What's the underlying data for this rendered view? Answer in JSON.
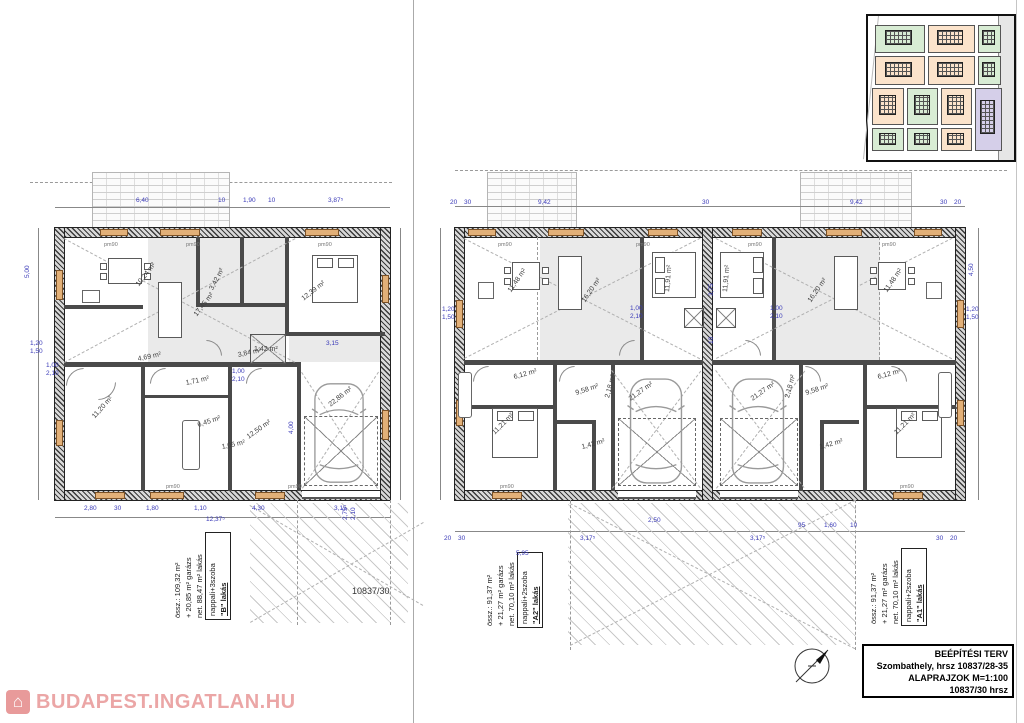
{
  "title_block": {
    "line1": "BEÉPÍTÉSI TERV",
    "line2": "Szombathely, hrsz 10837/28-35",
    "line3": "ALAPRAJZOK M=1:100",
    "line4": "10837/30 hrsz"
  },
  "watermark": {
    "text": "BUDAPEST.INGATLAN.HU",
    "color": "#eba6a6"
  },
  "sheet": {
    "parcel_label": "10837/30"
  },
  "units": {
    "b": {
      "title": "\"B\" lakás",
      "subtitle": "nappali+3szoba",
      "net": "net. 88,47 m² lakás",
      "garage": "+ 20,85 m² garázs",
      "total": "össz.: 109,32 m²"
    },
    "a2": {
      "title": "\"A2\" lakás",
      "subtitle": "nappali+2szoba",
      "net": "net. 70,10 m² lakás",
      "garage": "+ 21,27 m² garázs",
      "total": "össz.: 91,37 m²"
    },
    "a1": {
      "title": "\"A1\" lakás",
      "subtitle": "nappali+2szoba",
      "net": "net. 70,10 m² lakás",
      "garage": "+ 21,27 m² garázs",
      "total": "össz.: 91,37 m²"
    }
  },
  "left_plan": {
    "rooms": [
      {
        "t": "10,24 m²",
        "x": 138,
        "y": 282,
        "r": -52
      },
      {
        "t": "17,45 m²",
        "x": 196,
        "y": 312,
        "r": -52
      },
      {
        "t": "12,39 m²",
        "x": 303,
        "y": 296,
        "r": -38
      },
      {
        "t": "3,42 m²",
        "x": 212,
        "y": 286,
        "r": -62
      },
      {
        "t": "1,42 m²",
        "x": 254,
        "y": 346,
        "r": 0
      },
      {
        "t": "4,69 m²",
        "x": 138,
        "y": 356,
        "r": -12
      },
      {
        "t": "3,84 m²",
        "x": 238,
        "y": 352,
        "r": -12
      },
      {
        "t": "11,20 m²",
        "x": 94,
        "y": 414,
        "r": -48
      },
      {
        "t": "1,71 m²",
        "x": 186,
        "y": 380,
        "r": -12
      },
      {
        "t": "6,45 m²",
        "x": 198,
        "y": 422,
        "r": -18
      },
      {
        "t": "1,05 m²",
        "x": 222,
        "y": 444,
        "r": -12
      },
      {
        "t": "12,50 m²",
        "x": 248,
        "y": 434,
        "r": -35
      },
      {
        "t": "22,86 m²",
        "x": 330,
        "y": 402,
        "r": -38
      }
    ],
    "dims": [
      {
        "t": "6,40",
        "x": 136,
        "y": 197
      },
      {
        "t": "10",
        "x": 218,
        "y": 197
      },
      {
        "t": "1,90",
        "x": 243,
        "y": 197
      },
      {
        "t": "10",
        "x": 268,
        "y": 197
      },
      {
        "t": "3,87⁵",
        "x": 328,
        "y": 197
      },
      {
        "t": "2,80",
        "x": 84,
        "y": 505
      },
      {
        "t": "30",
        "x": 114,
        "y": 505
      },
      {
        "t": "1,80",
        "x": 146,
        "y": 505
      },
      {
        "t": "1,10",
        "x": 194,
        "y": 505
      },
      {
        "t": "4,30",
        "x": 252,
        "y": 505
      },
      {
        "t": "3,15",
        "x": 334,
        "y": 505
      },
      {
        "t": "12,37⁵",
        "x": 206,
        "y": 516
      },
      {
        "t": "5,00",
        "x": 24,
        "y": 278,
        "r": -90
      },
      {
        "t": "4,00",
        "x": 288,
        "y": 434,
        "r": -90
      },
      {
        "t": "1,00",
        "x": 46,
        "y": 362
      },
      {
        "t": "2,10",
        "x": 46,
        "y": 370
      },
      {
        "t": "1,00",
        "x": 232,
        "y": 368
      },
      {
        "t": "2,10",
        "x": 232,
        "y": 376
      },
      {
        "t": "3,15",
        "x": 326,
        "y": 340
      },
      {
        "t": "2,75",
        "x": 342,
        "y": 520,
        "r": -90
      },
      {
        "t": "2,10",
        "x": 350,
        "y": 520,
        "r": -90
      },
      {
        "t": "1,20",
        "x": 30,
        "y": 340
      },
      {
        "t": "1,50",
        "x": 30,
        "y": 348
      }
    ],
    "marks": [
      {
        "t": "pm90",
        "x": 104,
        "y": 242
      },
      {
        "t": "pm90",
        "x": 186,
        "y": 242
      },
      {
        "t": "pm90",
        "x": 318,
        "y": 242
      },
      {
        "t": "pm90",
        "x": 166,
        "y": 484
      },
      {
        "t": "pm90",
        "x": 288,
        "y": 484
      }
    ]
  },
  "right_plan": {
    "rooms": [
      {
        "t": "11,48 m²",
        "x": 510,
        "y": 288,
        "r": -55
      },
      {
        "t": "16,20 m²",
        "x": 584,
        "y": 298,
        "r": -55
      },
      {
        "t": "11,91 m²",
        "x": 668,
        "y": 288,
        "r": -85
      },
      {
        "t": "11,91 m²",
        "x": 726,
        "y": 288,
        "r": -85
      },
      {
        "t": "16,20 m²",
        "x": 810,
        "y": 298,
        "r": -55
      },
      {
        "t": "11,48 m²",
        "x": 886,
        "y": 288,
        "r": -55
      },
      {
        "t": "6,12 m²",
        "x": 514,
        "y": 374,
        "r": -15
      },
      {
        "t": "9,58 m²",
        "x": 576,
        "y": 390,
        "r": -18
      },
      {
        "t": "2,18 m²",
        "x": 608,
        "y": 394,
        "r": -75
      },
      {
        "t": "21,27 m²",
        "x": 630,
        "y": 396,
        "r": -35
      },
      {
        "t": "21,27 m²",
        "x": 752,
        "y": 396,
        "r": -35
      },
      {
        "t": "2,18 m²",
        "x": 788,
        "y": 394,
        "r": -75
      },
      {
        "t": "9,58 m²",
        "x": 806,
        "y": 390,
        "r": -18
      },
      {
        "t": "6,12 m²",
        "x": 878,
        "y": 374,
        "r": -15
      },
      {
        "t": "11,21 m²",
        "x": 494,
        "y": 430,
        "r": -45
      },
      {
        "t": "11,21 m²",
        "x": 896,
        "y": 430,
        "r": -45
      },
      {
        "t": "1,42 m²",
        "x": 582,
        "y": 444,
        "r": -15
      },
      {
        "t": "1,42 m²",
        "x": 820,
        "y": 444,
        "r": -15
      }
    ],
    "dims": [
      {
        "t": "20",
        "x": 450,
        "y": 199
      },
      {
        "t": "30",
        "x": 464,
        "y": 199
      },
      {
        "t": "9,42",
        "x": 538,
        "y": 199
      },
      {
        "t": "30",
        "x": 702,
        "y": 199
      },
      {
        "t": "9,42",
        "x": 850,
        "y": 199
      },
      {
        "t": "30",
        "x": 940,
        "y": 199
      },
      {
        "t": "20",
        "x": 954,
        "y": 199
      },
      {
        "t": "3,17⁵",
        "x": 580,
        "y": 535
      },
      {
        "t": "3,17⁵",
        "x": 750,
        "y": 535
      },
      {
        "t": "2,50",
        "x": 648,
        "y": 517
      },
      {
        "t": "95",
        "x": 798,
        "y": 522
      },
      {
        "t": "1,60",
        "x": 824,
        "y": 522
      },
      {
        "t": "10",
        "x": 850,
        "y": 522
      },
      {
        "t": "5,95",
        "x": 516,
        "y": 550
      },
      {
        "t": "20",
        "x": 444,
        "y": 535
      },
      {
        "t": "30",
        "x": 458,
        "y": 535
      },
      {
        "t": "30",
        "x": 936,
        "y": 535
      },
      {
        "t": "20",
        "x": 950,
        "y": 535
      },
      {
        "t": "3,75",
        "x": 708,
        "y": 296,
        "r": -90
      },
      {
        "t": "10",
        "x": 708,
        "y": 344,
        "r": -90
      },
      {
        "t": "4,50",
        "x": 968,
        "y": 276,
        "r": -90
      },
      {
        "t": "1,20",
        "x": 442,
        "y": 306
      },
      {
        "t": "1,50",
        "x": 442,
        "y": 314
      },
      {
        "t": "1,20",
        "x": 966,
        "y": 306
      },
      {
        "t": "1,50",
        "x": 966,
        "y": 314
      },
      {
        "t": "1,00",
        "x": 630,
        "y": 305
      },
      {
        "t": "2,10",
        "x": 630,
        "y": 313
      },
      {
        "t": "1,00",
        "x": 770,
        "y": 305
      },
      {
        "t": "2,10",
        "x": 770,
        "y": 313
      }
    ],
    "marks": [
      {
        "t": "pm90",
        "x": 498,
        "y": 242
      },
      {
        "t": "pm90",
        "x": 636,
        "y": 242
      },
      {
        "t": "pm90",
        "x": 748,
        "y": 242
      },
      {
        "t": "pm90",
        "x": 882,
        "y": 242
      },
      {
        "t": "pm90",
        "x": 500,
        "y": 484
      },
      {
        "t": "pm90",
        "x": 900,
        "y": 484
      }
    ]
  },
  "site_inset": {
    "parcels": [
      {
        "x": 5,
        "y": 6,
        "w": 34,
        "h": 20,
        "c": "g"
      },
      {
        "x": 41,
        "y": 6,
        "w": 32,
        "h": 20,
        "c": "p"
      },
      {
        "x": 75,
        "y": 6,
        "w": 16,
        "h": 20,
        "c": "g"
      },
      {
        "x": 5,
        "y": 28,
        "w": 34,
        "h": 20,
        "c": "p"
      },
      {
        "x": 41,
        "y": 28,
        "w": 32,
        "h": 20,
        "c": "p"
      },
      {
        "x": 75,
        "y": 28,
        "w": 16,
        "h": 20,
        "c": "g"
      },
      {
        "x": 3,
        "y": 50,
        "w": 22,
        "h": 26,
        "c": "p"
      },
      {
        "x": 27,
        "y": 50,
        "w": 21,
        "h": 26,
        "c": "g"
      },
      {
        "x": 50,
        "y": 50,
        "w": 21,
        "h": 26,
        "c": "p"
      },
      {
        "x": 73,
        "y": 50,
        "w": 19,
        "h": 44,
        "c": "v"
      },
      {
        "x": 3,
        "y": 78,
        "w": 22,
        "h": 16,
        "c": "g"
      },
      {
        "x": 27,
        "y": 78,
        "w": 21,
        "h": 16,
        "c": "g"
      },
      {
        "x": 50,
        "y": 78,
        "w": 21,
        "h": 16,
        "c": "p"
      }
    ],
    "colors": {
      "g": "#d8ecd4",
      "p": "#fbe3cb",
      "v": "#d5cfe9"
    }
  },
  "colors": {
    "dimension_text": "#3a3ab8",
    "window_marker": "#e2b078",
    "watermark": "#eba6a6",
    "room_shading": "#eaeaea"
  }
}
